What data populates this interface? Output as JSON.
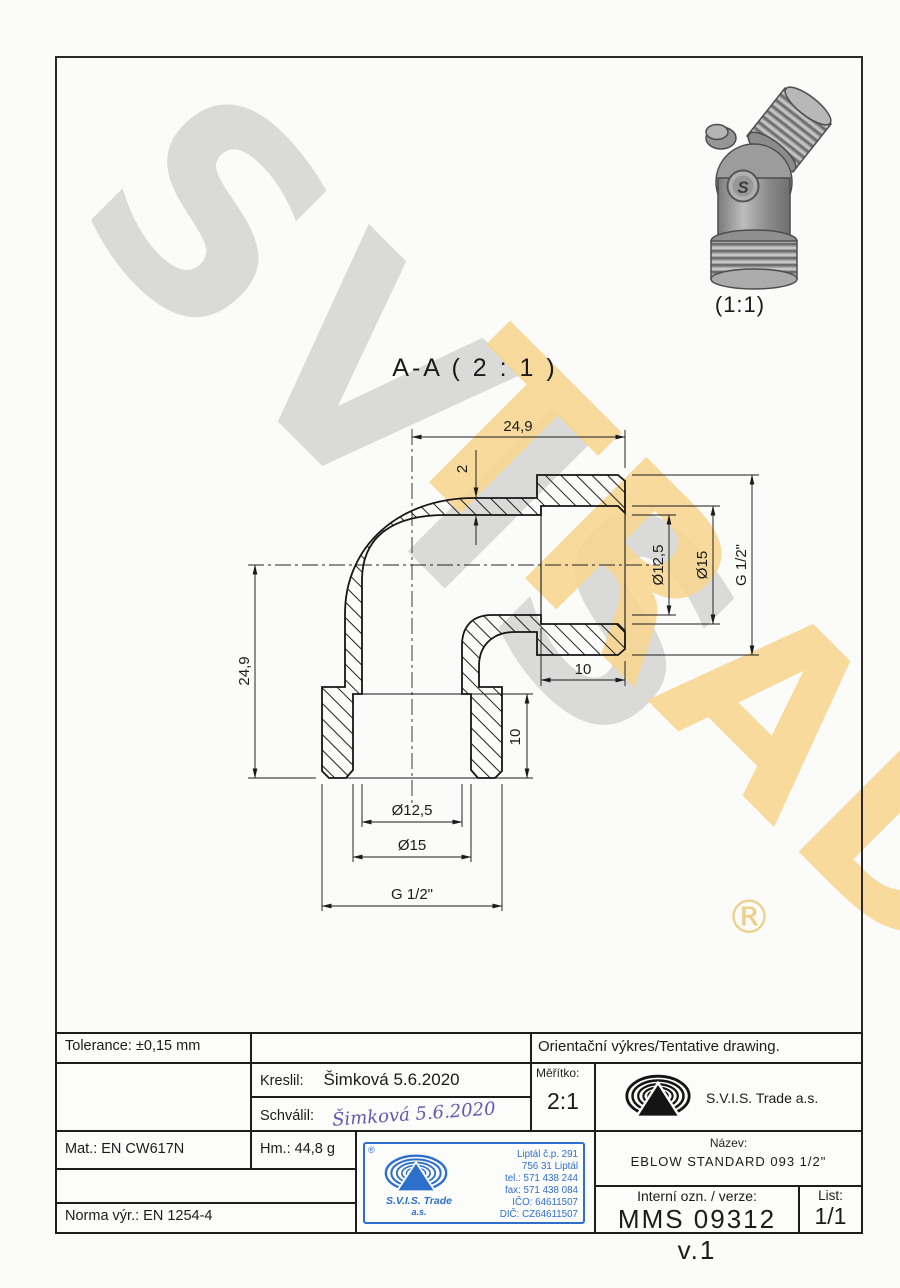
{
  "watermark": {
    "word1": "SVIS",
    "word2": "TRADE",
    "registered": "®"
  },
  "iso": {
    "scale_label": "(1:1)"
  },
  "section": {
    "title": "A-A ( 2 : 1 )"
  },
  "dims": {
    "top_width": "24,9",
    "wall_thickness": "2",
    "right_bore": "Ø12,5",
    "right_counterbore": "Ø15",
    "right_thread": "G 1/2\"",
    "left_height": "24,9",
    "horizontal_depth": "10",
    "vertical_depth": "10",
    "bottom_bore": "Ø12,5",
    "bottom_counterbore": "Ø15",
    "bottom_thread": "G 1/2\""
  },
  "titleblock": {
    "tolerance": "Tolerance: ±0,15 mm",
    "orientation_note": "Orientační výkres/Tentative drawing.",
    "kreslil_label": "Kreslil:",
    "kreslil_value": "Šimková 5.6.2020",
    "schvalil_label": "Schválil:",
    "schvalil_signature": "Šimková 5.6.2020",
    "meritko_label": "Měřítko:",
    "meritko_value": "2:1",
    "company_name": "S.V.I.S. Trade a.s.",
    "material": "Mat.: EN CW617N",
    "weight": "Hm.: 44,8 g",
    "norm": "Norma výr.: EN 1254-4",
    "nazev_label": "Název:",
    "nazev_value": "EBLOW STANDARD 093 1/2\"",
    "internal_label": "Interní ozn. / verze:",
    "internal_value": "MMS 09312 v.1",
    "list_label": "List:",
    "list_value": "1/1"
  },
  "stamp": {
    "registered": "®",
    "company_line1": "S.V.I.S. Trade",
    "company_line2": "a.s.",
    "address_line1": "Liptál č.p. 291",
    "address_line2": "756 31 Liptál",
    "address_line3": "tel.: 571 438 244",
    "address_line4": "fax: 571 438 084",
    "address_line5": "IČO: 64611507",
    "address_line6": "DIČ: CZ64611507"
  }
}
